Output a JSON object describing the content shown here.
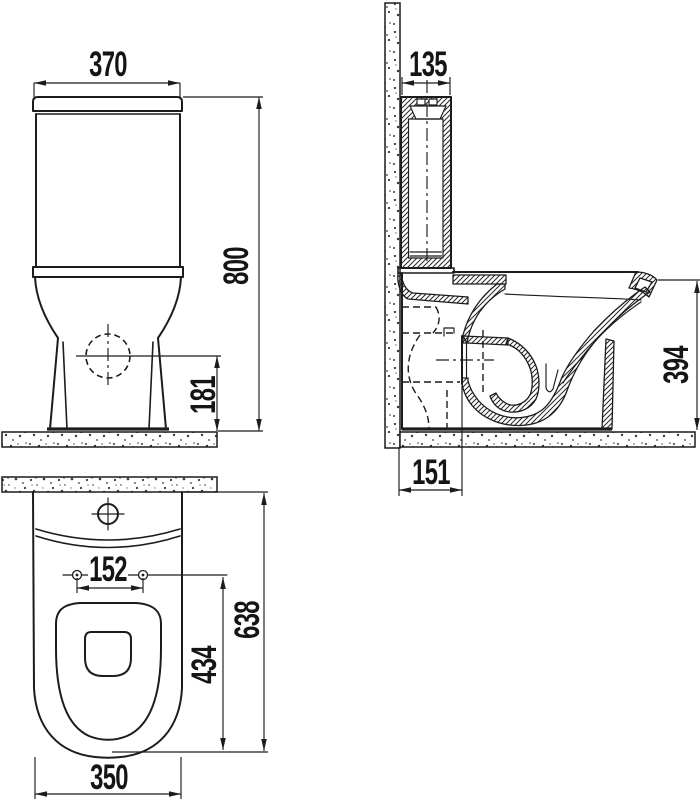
{
  "colors": {
    "ink": "#1c1c1c",
    "paper": "#ffffff",
    "speckle": "#3a3a3a"
  },
  "dimensions": {
    "front_tank_width": "370",
    "front_overall_height": "800",
    "front_outlet_height": "181",
    "side_tank_depth": "135",
    "side_bowl_height": "394",
    "side_outlet_projection": "151",
    "top_hole_spacing": "152",
    "top_seat_depth": "434",
    "top_overall_depth": "638",
    "top_bowl_width": "350"
  }
}
